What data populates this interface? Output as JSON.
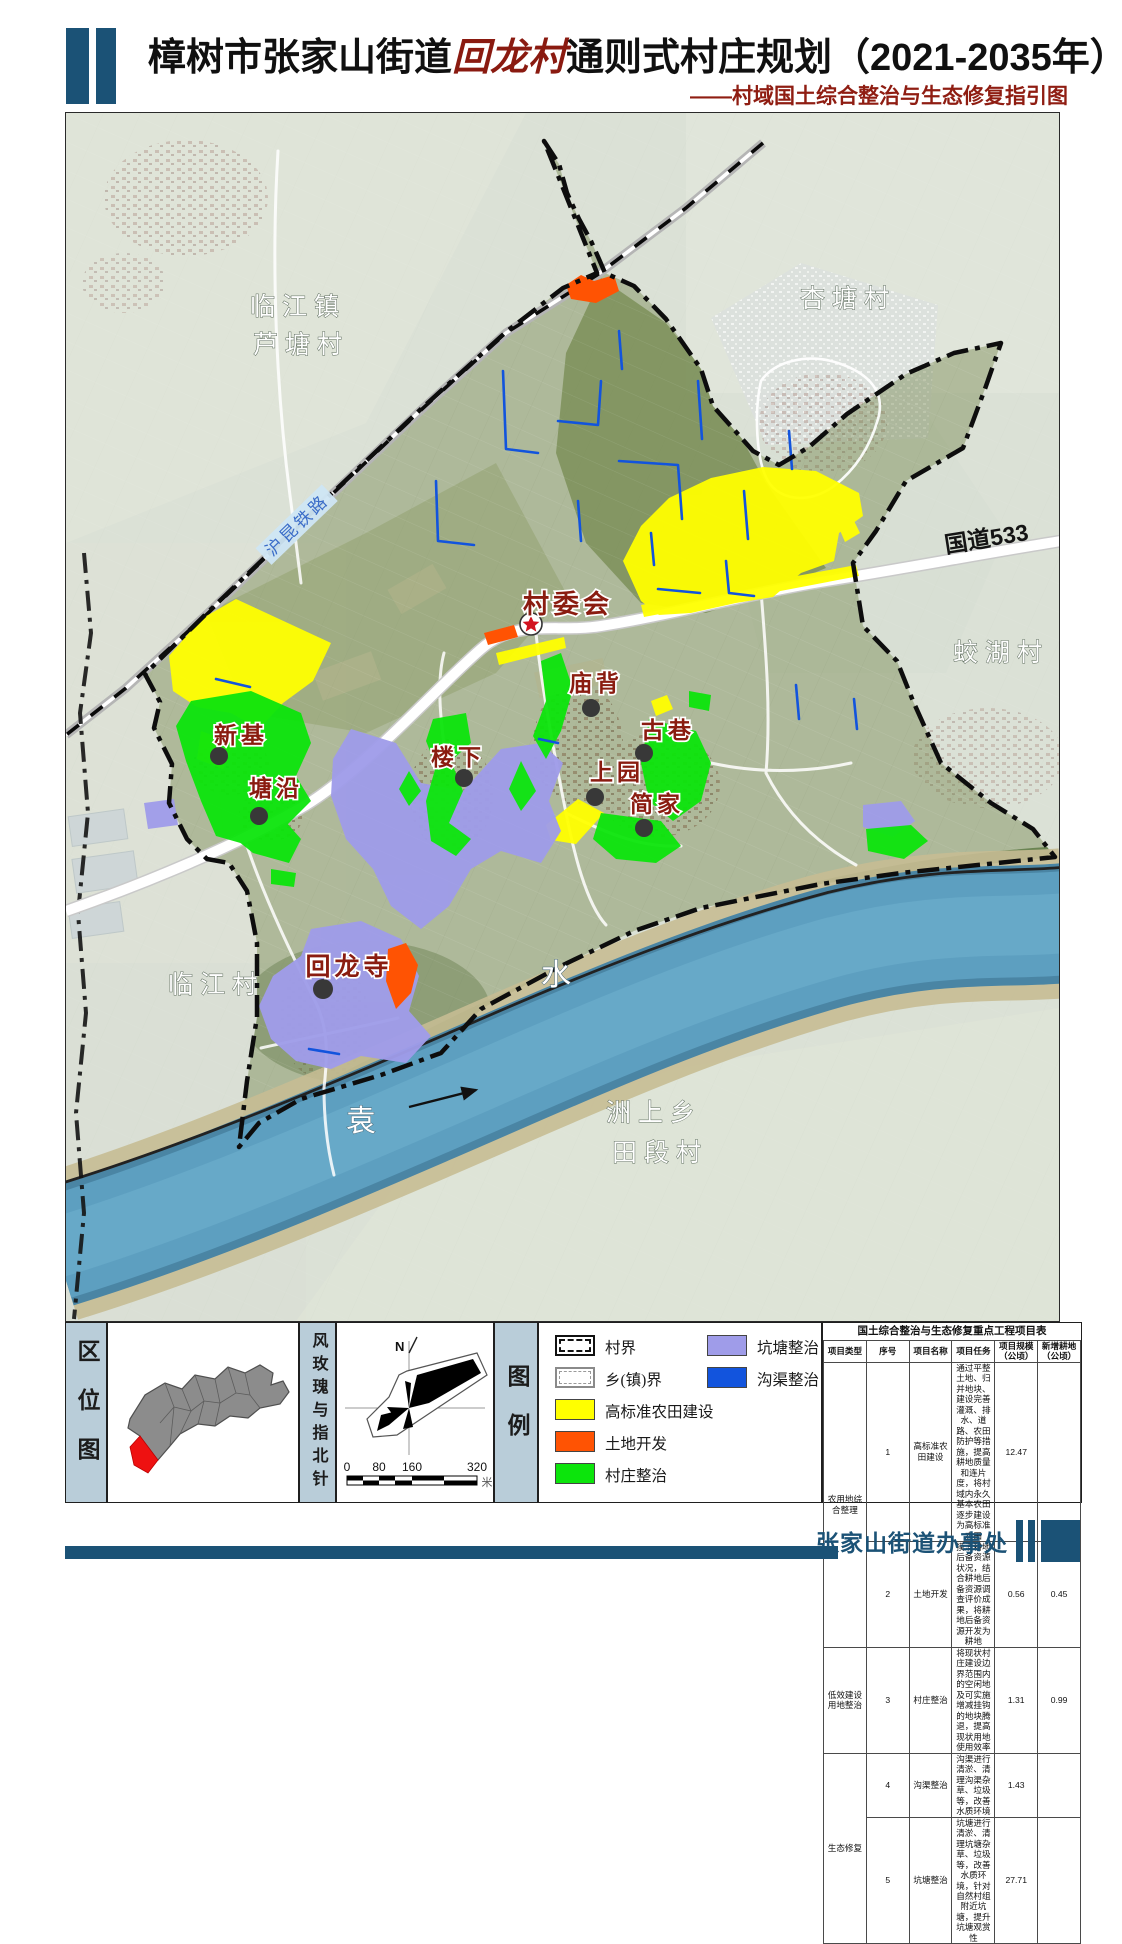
{
  "header": {
    "title_prefix": "樟树市张家山街道",
    "title_highlight": "回龙村",
    "title_suffix": "通则式村庄规划（2021-2035年）",
    "subtitle": "——村域国土综合整治与生态修复指引图"
  },
  "map": {
    "place_labels": [
      "临江镇",
      "芦塘村",
      "杏塘村",
      "蛟湖村",
      "临江村",
      "洲上乡",
      "田段村"
    ],
    "hamlets": [
      "村委会",
      "庙背",
      "新基",
      "塘沿",
      "楼下",
      "古巷",
      "上园",
      "简家",
      "回龙寺"
    ],
    "river_chars": [
      "袁",
      "水"
    ],
    "railway_label": "沪昆铁路",
    "road_label": "国道533"
  },
  "panels": {
    "location_label": "区位图",
    "windrose_label": "风玫瑰与指北针",
    "legend_label": "图例",
    "north": "N",
    "scale_ticks": [
      "0",
      "80",
      "160",
      "320"
    ],
    "scale_unit": "米"
  },
  "legend": {
    "items": [
      {
        "label": "村界",
        "kind": "dash-black"
      },
      {
        "label": "乡(镇)界",
        "kind": "dash-gray"
      },
      {
        "label": "高标准农田建设",
        "color": "#ffff00"
      },
      {
        "label": "土地开发",
        "color": "#ff5303"
      },
      {
        "label": "村庄整治",
        "color": "#0ce50c"
      },
      {
        "label": "坑塘整治",
        "color": "#9f9ce9"
      },
      {
        "label": "沟渠整治",
        "color": "#1254dd"
      }
    ]
  },
  "colors": {
    "navy": "#1b5276",
    "title_red": "#8a1a10",
    "yellow": "#ffff00",
    "orange": "#ff5303",
    "green": "#0ce50c",
    "lavender": "#9f9ce9",
    "ditch_blue": "#1254dd",
    "river": "#5d9fc0",
    "region_red": "#ee1111"
  },
  "table": {
    "title": "国土综合整治与生态修复重点工程项目表",
    "headers": {
      "type": "项目类型",
      "no": "序号",
      "name": "项目名称",
      "task": "项目任务",
      "scale": "项目规模（公顷）",
      "added": "新增耕地（公顷）"
    },
    "groups": [
      "农用地综合整理",
      "低效建设用地整治",
      "生态修复"
    ],
    "rows": [
      {
        "no": "1",
        "name": "高标准农田建设",
        "task": "通过平整土地、归并地块、建设完善灌溉、排水、道路、农田防护等措施，提高耕地质量和连片度，将村域内永久基本农田逐步建设为高标准农田",
        "scale": "12.47",
        "added": ""
      },
      {
        "no": "2",
        "name": "土地开发",
        "task": "摸清耕地后备资源状况，结合耕地后备资源调查评价成果，将耕地后备资源开发为耕地",
        "scale": "0.56",
        "added": "0.45"
      },
      {
        "no": "3",
        "name": "村庄整治",
        "task": "将现状村庄建设边界范围内的空闲地及可实施增减挂钩的地块腾退，提高现状用地使用效率",
        "scale": "1.31",
        "added": "0.99"
      },
      {
        "no": "4",
        "name": "沟渠整治",
        "task": "沟渠进行清淤、清理沟渠杂草、垃圾等，改善水质环境",
        "scale": "1.43",
        "added": ""
      },
      {
        "no": "5",
        "name": "坑塘整治",
        "task": "坑塘进行清淤、清理坑塘杂草、垃圾等，改善水质环境，针对自然村组附近坑塘，提升坑塘观赏性",
        "scale": "27.71",
        "added": ""
      }
    ]
  },
  "footer": {
    "org": "张家山街道办事处"
  }
}
